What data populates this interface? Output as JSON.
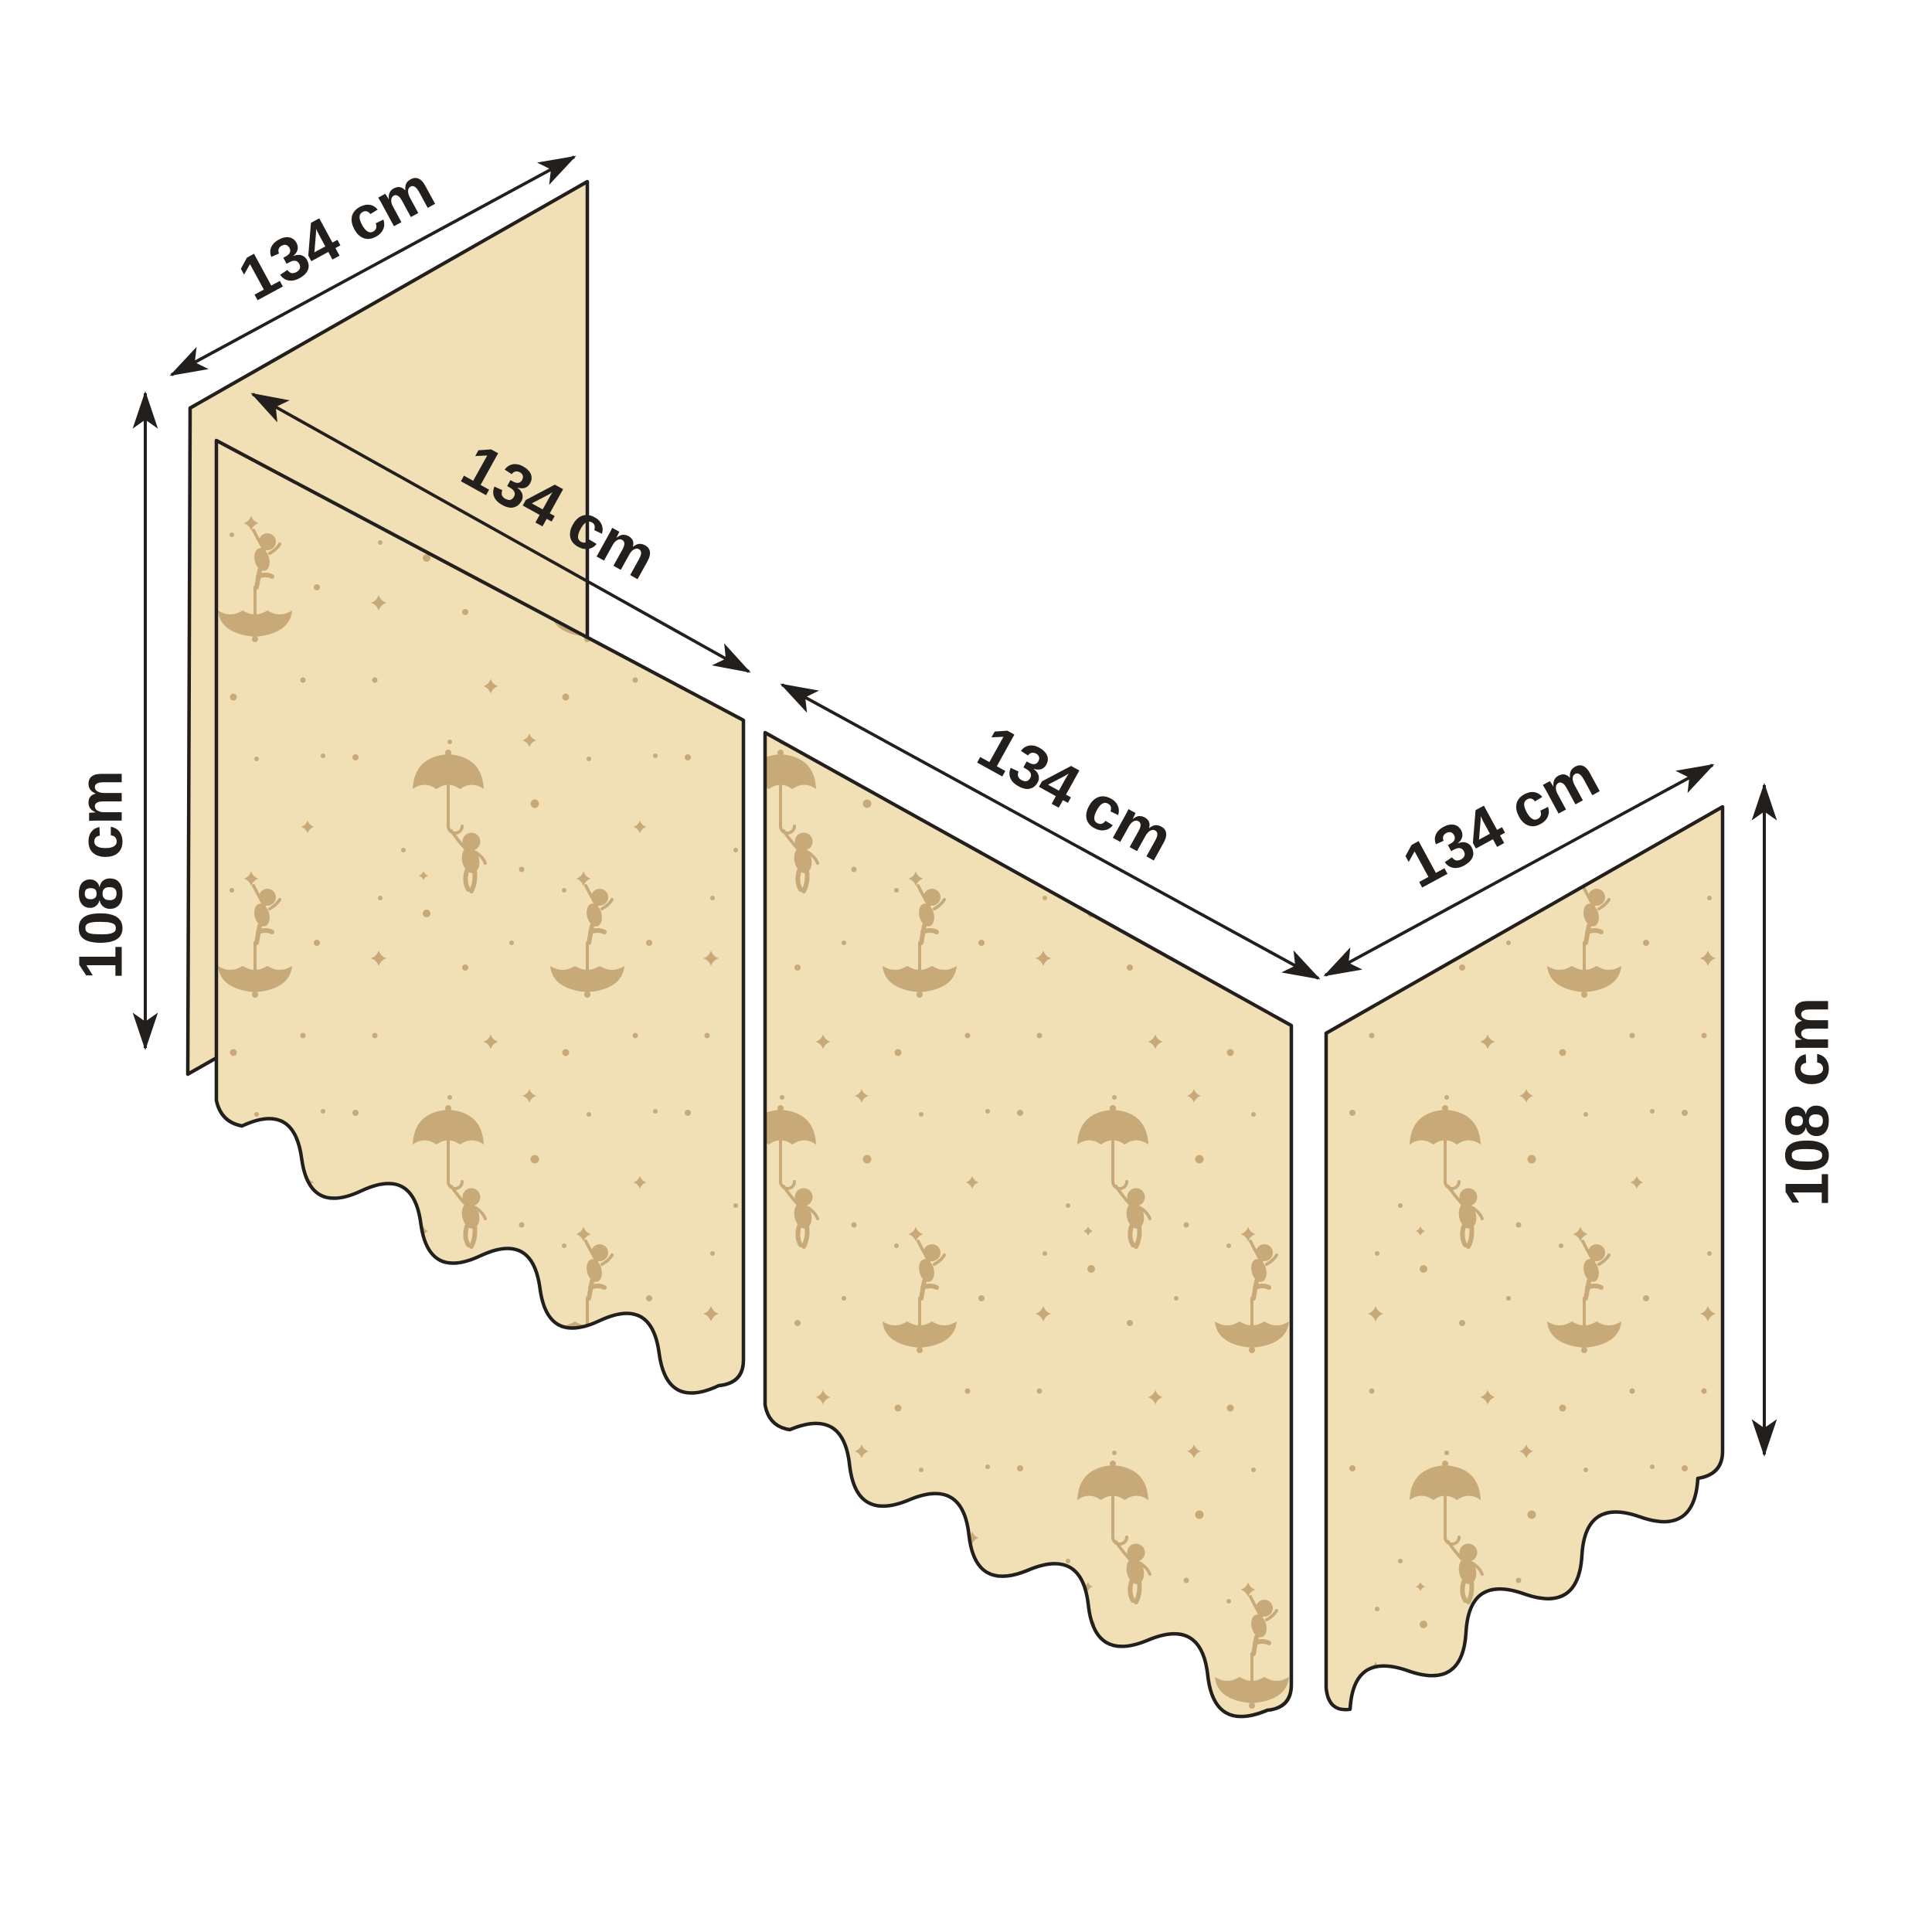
{
  "diagram": {
    "dimension_labels": {
      "back_panel_width": "134 cm",
      "front_left_panel_width": "134 cm",
      "front_middle_panel_width": "134 cm",
      "side_panel_width": "134 cm",
      "left_panel_height": "108 cm",
      "right_panel_height": "108 cm"
    },
    "colors": {
      "background": "#ffffff",
      "fabric": "#f1dfb6",
      "motif": "#c7aa78",
      "outline": "#231f1c"
    }
  }
}
